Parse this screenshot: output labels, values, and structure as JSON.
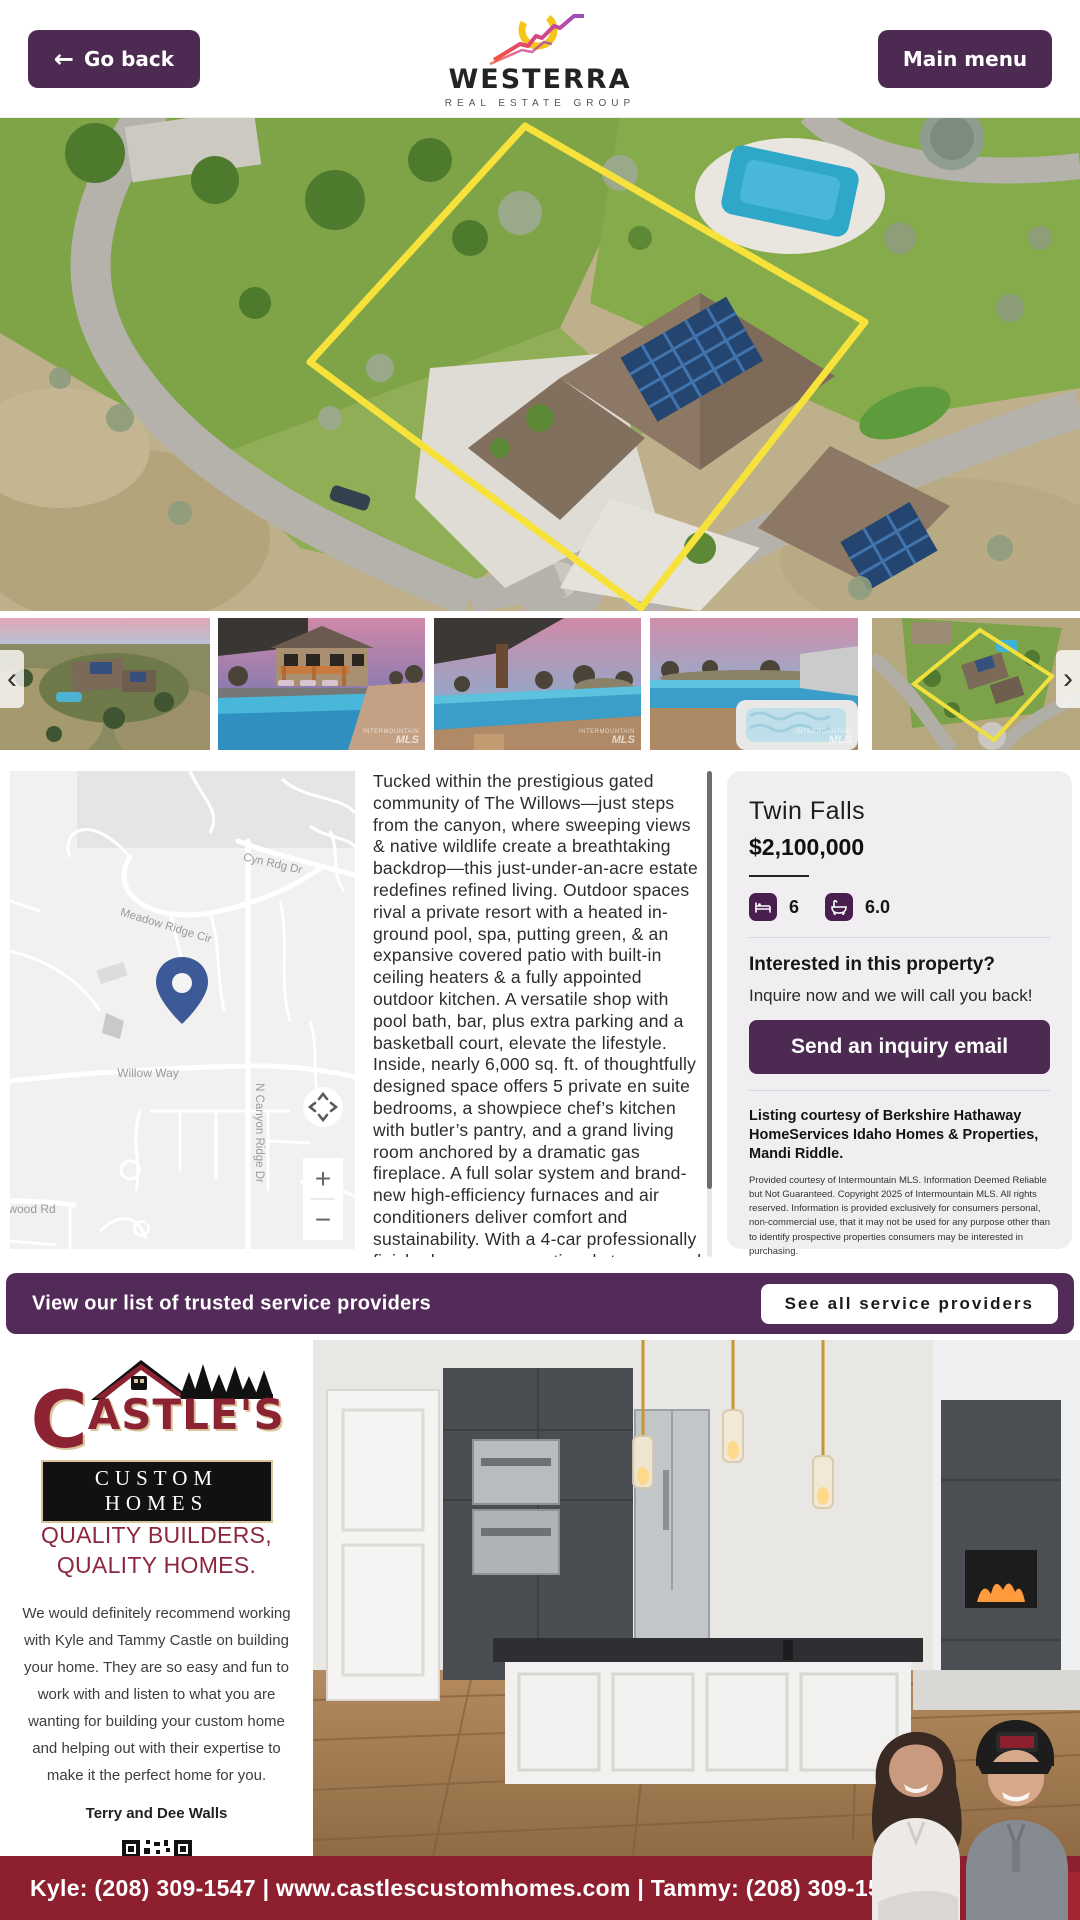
{
  "header": {
    "back_arrow": "←",
    "go_back_label": "Go back",
    "main_menu_label": "Main menu",
    "brand_name": "WESTERRA",
    "brand_tagline": "REAL ESTATE GROUP"
  },
  "gallery": {
    "prev_arrow": "‹",
    "next_arrow": "›",
    "watermark_line1": "INTERMOUNTAIN",
    "watermark_line2": "MLS"
  },
  "map": {
    "street_labels": [
      "Cyn Rdg Dr",
      "Meadow Ridge Cir",
      "Willow Way",
      "N Canyon Ridge Dr",
      "wood Rd"
    ],
    "zoom_in_label": "+",
    "zoom_out_label": "−"
  },
  "property": {
    "description": "Tucked within the prestigious gated community of The Willows—just steps from the canyon, where sweeping views & native wildlife create a breathtaking backdrop—this just-under-an-acre estate redefines refined living. Outdoor spaces rival a private resort with a heated in-ground pool, spa, putting green, & an expansive covered patio with built-in ceiling heaters & a fully appointed outdoor kitchen. A versatile shop with pool bath, bar, plus extra parking and a basketball court, elevate the lifestyle. Inside, nearly 6,000 sq. ft. of thoughtfully designed space offers 5 private en suite bedrooms, a showpiece chef’s kitchen with butler’s pantry, and a grand living room anchored by a dramatic gas fireplace. A full solar system and brand-new high-efficiency furnaces and air conditioners deliver comfort and sustainability. With a 4-car professionally finished garage, exceptional storage, and access to the community’s shared horse pasture, this residence blends",
    "city": "Twin Falls",
    "price": "$2,100,000",
    "beds": "6",
    "baths": "6.0",
    "interest_heading": "Interested in this property?",
    "interest_subtext": "Inquire now and we will call you back!",
    "inquiry_button_label": "Send an inquiry email",
    "courtesy": "Listing courtesy of Berkshire Hathaway HomeServices Idaho Homes & Properties, Mandi Riddle.",
    "mls_disclaimer": "Provided courtesy of Intermountain MLS. Information Deemed Reliable but Not Guaranteed. Copyright 2025 of Intermountain MLS. All rights reserved. Information is provided exclusively for consumers personal, non-commercial use, that it may not be used for any purpose other than to identify prospective properties consumers may be interested in purchasing.",
    "last_updated": "Last updated | 2026-03-21 05:45:00"
  },
  "providers_banner": {
    "text": "View our list of trusted service providers",
    "button_label": "See all service providers"
  },
  "sponsor_ad": {
    "brand_initial": "C",
    "brand_rest": "ASTLE'S",
    "brand_bar": "CUSTOM HOMES",
    "tagline_line1": "QUALITY BUILDERS,",
    "tagline_line2": "QUALITY HOMES.",
    "testimonial": "We would definitely recommend working with Kyle and Tammy Castle on building your home. They are so easy and fun to work with and listen to what you are wanting for building your custom home and helping out with their expertise to make it the perfect home for you.",
    "testimonial_author": "Terry and Dee Walls",
    "contact_bar": "Kyle: (208) 309-1547  |  www.castlescustomhomes.com  |  Tammy: (208) 309-1549"
  },
  "colors": {
    "primary_purple": "#4c2a52",
    "banner_purple": "#522b58",
    "maroon": "#8d1f2f",
    "map_pin_blue": "#3d5a98",
    "boundary_yellow": "#f7e23c"
  }
}
